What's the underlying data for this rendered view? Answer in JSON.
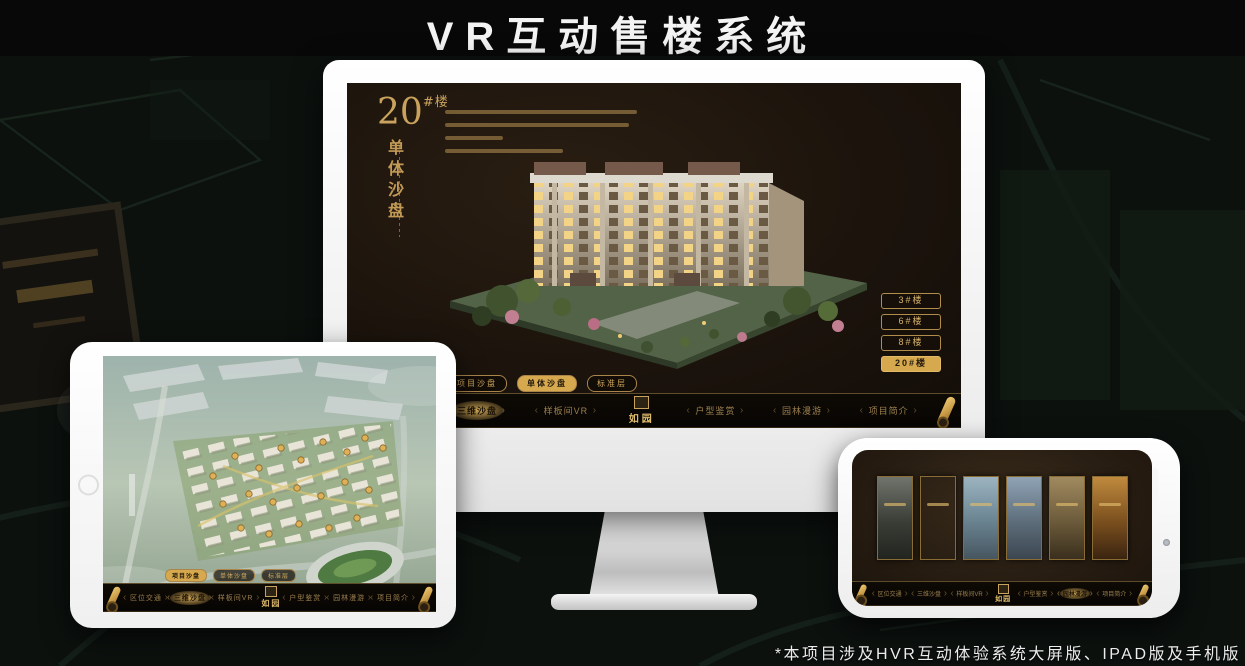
{
  "page": {
    "title": "VR互动售楼系统",
    "footnote": "*本项目涉及HVR互动体验系统大屏版、IPAD版及手机版"
  },
  "brand": {
    "logo": "如园"
  },
  "colors": {
    "gold": "#c9a35d",
    "gold_selected": "#d7a94f",
    "screen_background": "#1b130c",
    "title_text": "#f4f4f4"
  },
  "nav": {
    "items": [
      {
        "label": "区位交通"
      },
      {
        "label": "三维沙盘"
      },
      {
        "label": "样板间VR"
      },
      {
        "label": "户型鉴赏"
      },
      {
        "label": "园林漫游"
      },
      {
        "label": "项目简介"
      }
    ]
  },
  "sub_tabs": [
    {
      "label": "项目沙盘"
    },
    {
      "label": "单体沙盘"
    },
    {
      "label": "标准层"
    }
  ],
  "monitor": {
    "headline_number": "20",
    "headline_suffix": "#楼",
    "headline_vertical": "单体沙盘",
    "selected_sub_tab": "单体沙盘",
    "selected_nav_item": "三维沙盘",
    "floor_buttons": [
      {
        "label": "3#楼",
        "selected": false
      },
      {
        "label": "6#楼",
        "selected": false
      },
      {
        "label": "8#楼",
        "selected": false
      },
      {
        "label": "20#楼",
        "selected": true
      }
    ]
  },
  "ipad": {
    "selected_sub_tab": "项目沙盘",
    "selected_nav_item": "三维沙盘"
  },
  "phone": {
    "selected_nav_item": "园林漫游"
  }
}
